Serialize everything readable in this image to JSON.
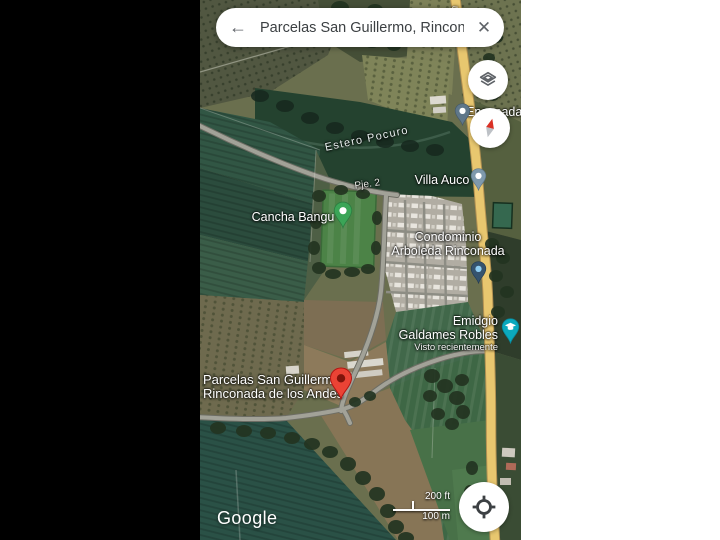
{
  "search_bar": {
    "query": "Parcelas San Guillermo, Rincon...",
    "back_icon": "←",
    "clear_icon": "✕"
  },
  "map_labels": {
    "water": "Estero Pocuro",
    "road_small": "Pje. 2",
    "road_vertical": "tín",
    "villa_auco": "Villa Auco",
    "cancha_bangu": "Cancha Bangu",
    "condominio_line1": "Condominio",
    "condominio_line2": "Arboleda Rinconada",
    "emidgio_line1": "Emidgio",
    "emidgio_line2": "Galdames Robles",
    "emidgio_note": "Visto recientemente",
    "destination_line1": "Parcelas San Guillermo,",
    "destination_line2": "Rinconada de los Andes",
    "ensenada": "Ensenada"
  },
  "pins": {
    "destination": {
      "name": "destination-pin",
      "color": "#EA4335"
    },
    "cancha": {
      "name": "cancha-bangu-pin",
      "color": "#3BA557"
    },
    "villa_auco": {
      "name": "villa-auco-pin",
      "color": "#7E99AC"
    },
    "ensenada": {
      "name": "ensenada-pin",
      "color": "#5F7789"
    },
    "condominio": {
      "name": "condominio-saved-pin",
      "color": "#35536E"
    },
    "school": {
      "name": "school-pin",
      "color": "#0BA9BD"
    }
  },
  "scale_bar": {
    "imperial": "200 ft",
    "metric": "100 m"
  },
  "branding": {
    "logo_text": "Google"
  },
  "colors": {
    "road_primary": "#E8C76F",
    "pin_red": "#EA4335",
    "pin_green": "#3BA557",
    "pin_school": "#0BA9BD",
    "field_teal": "#2A5146",
    "letterbox_left": "#000000",
    "letterbox_right": "#FFFFFF"
  }
}
